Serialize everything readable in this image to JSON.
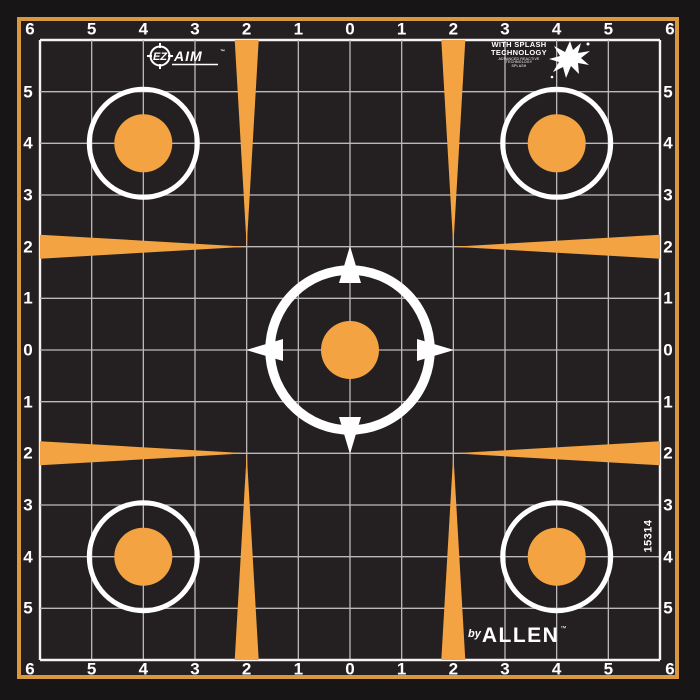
{
  "axis": {
    "labels": [
      "6",
      "5",
      "4",
      "3",
      "2",
      "1",
      "0",
      "1",
      "2",
      "3",
      "4",
      "5",
      "6"
    ]
  },
  "logos": {
    "ezaim": {
      "ez": "EZ",
      "aim": "AIM",
      "tm": "™"
    },
    "splash": {
      "line1": "WITH SPLASH",
      "line2": "TECHNOLOGY",
      "sub1": "ADVANCED REACTIVE TECHNOLOGY",
      "sub2": "SPLASH"
    },
    "allen": {
      "prefix": "by",
      "name": "ALLEN",
      "tm": "™"
    }
  },
  "sku": "15314",
  "colors": {
    "orange": "#F4A343",
    "border_orange": "#D9973E",
    "background": "#181516",
    "target_black": "#242021",
    "gridline": "#BDB9BA",
    "grid_edge": "#F4F2F2",
    "text_white": "#FFFFFF"
  }
}
